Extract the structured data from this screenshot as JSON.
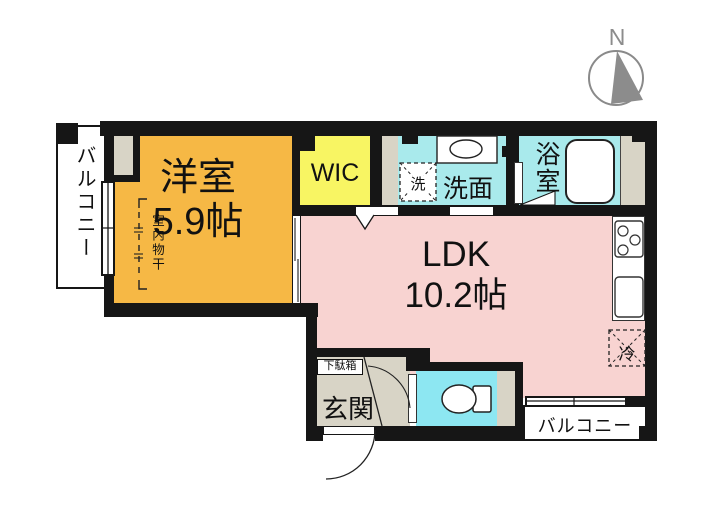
{
  "colors": {
    "wall": "#161616",
    "western_room": "#F6B845",
    "wic": "#F8F563",
    "wet": "#A9EAEC",
    "toilet": "#8DE7F2",
    "ldk": "#F8D3D1",
    "entrance": "#D8D4C6",
    "compass": "#8C8C8C"
  },
  "compass": {
    "north_label": "N"
  },
  "rooms": {
    "balcony_left": {
      "label": "バルコニー"
    },
    "western_room": {
      "name": "洋室",
      "size": "5.9帖",
      "drying_label": "室内物干"
    },
    "wic": {
      "label": "WIC"
    },
    "laundry": {
      "label": "洗"
    },
    "washroom": {
      "label": "洗面"
    },
    "bathroom": {
      "label": "浴室"
    },
    "ldk": {
      "name": "LDK",
      "size": "10.2帖"
    },
    "refrigerator": {
      "label": "冷"
    },
    "entrance": {
      "label": "玄関",
      "shoe_cabinet_label": "下駄箱"
    },
    "balcony_bottom": {
      "label": "バルコニー"
    }
  }
}
